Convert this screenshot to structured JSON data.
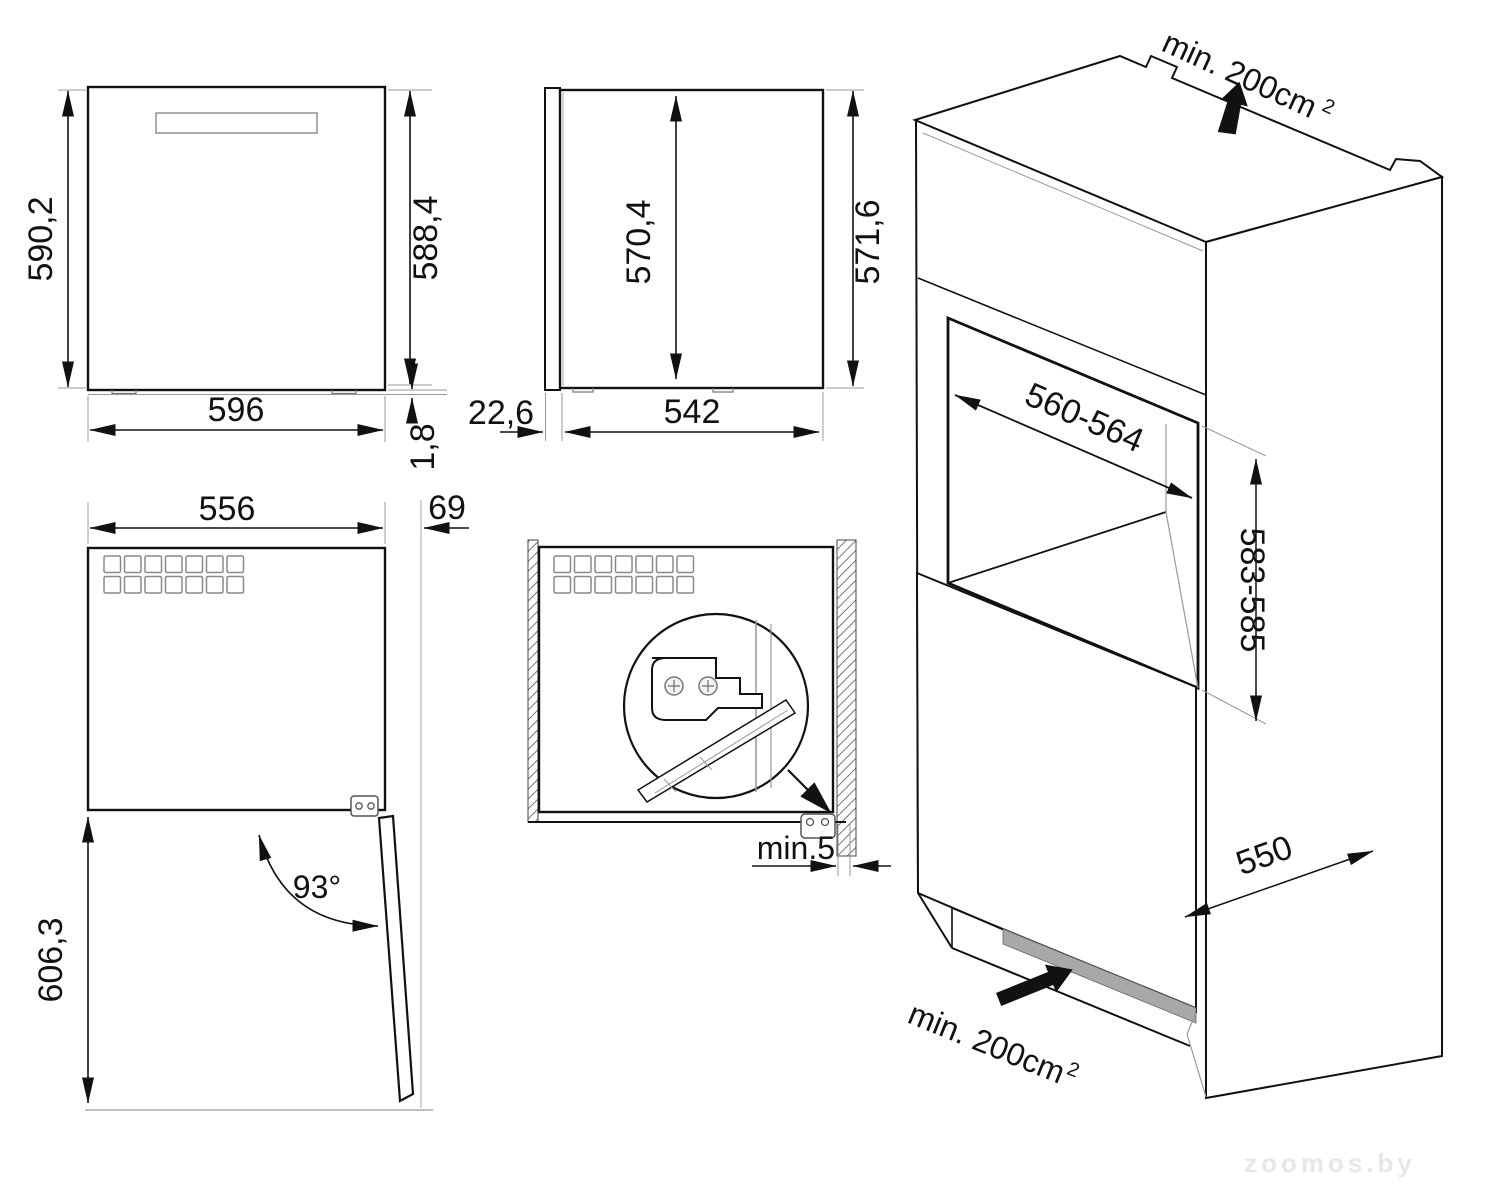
{
  "drawing": {
    "watermark": "zoomos.by",
    "front_view": {
      "height_overall": "590,2",
      "height_body": "588,4",
      "width": "596",
      "foot_height": "1,8"
    },
    "side_view": {
      "height_inner": "570,4",
      "height_outer": "571,6",
      "door_offset": "22,6",
      "depth_body": "542"
    },
    "open_door_view": {
      "width_body": "556",
      "door_thickness": "69",
      "opening_angle": "93°",
      "depth_with_open_door": "606,3"
    },
    "installed_view": {
      "side_clearance": "min.5"
    },
    "isometric_view": {
      "top_vent_area": "min. 200cm",
      "top_vent_area_sup": "2",
      "niche_width": "560-564",
      "niche_height": "583-585",
      "cabinet_depth": "550",
      "bottom_vent_area": "min. 200cm",
      "bottom_vent_area_sup": "2"
    }
  }
}
